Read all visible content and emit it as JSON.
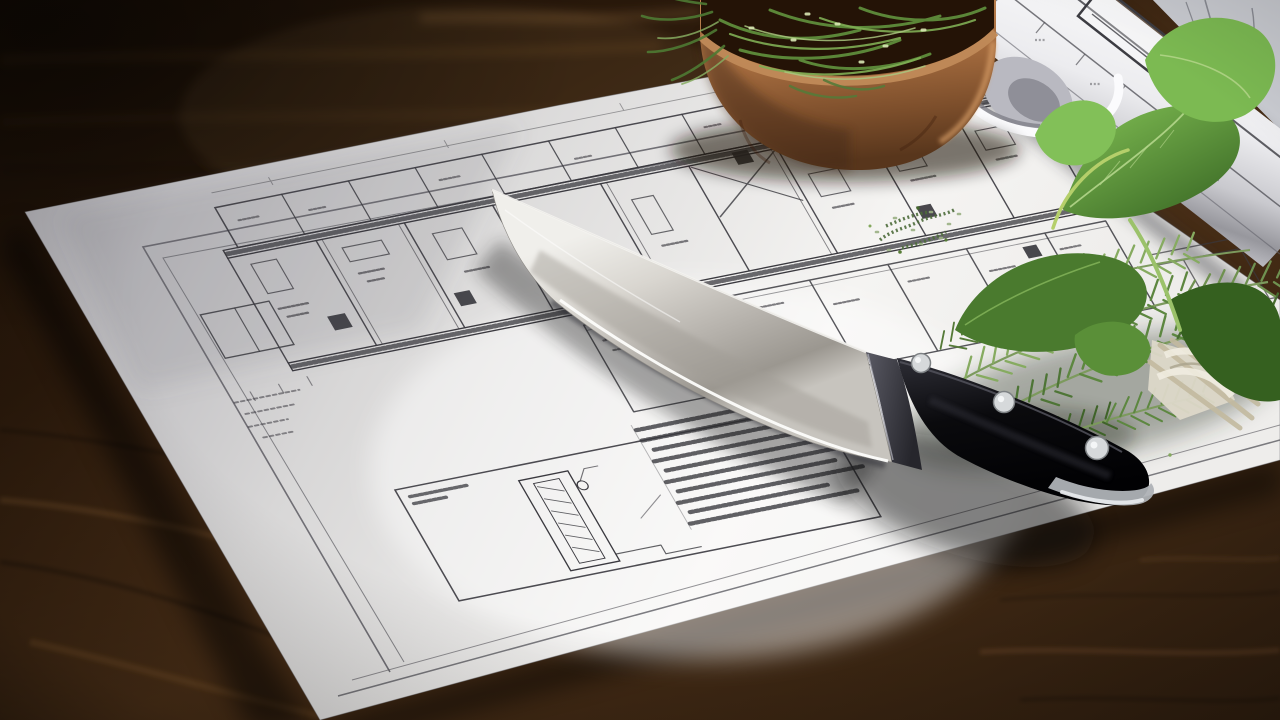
{
  "scene": {
    "title": "Chef's knife resting on architectural floor plans with fresh herbs on a dark wooden table",
    "setting": "dark rustic wooden table, warm side lighting, strong vignette",
    "objects": [
      {
        "name": "chef-knife",
        "parts": [
          "polished stainless blade",
          "dark steel bolster",
          "black handle",
          "three silver rivets",
          "steel butt cap"
        ]
      },
      {
        "name": "floor-plan-sheet",
        "details": [
          "double border frame",
          "two wings of small rooms",
          "hatched corridor walls",
          "black door symbols",
          "dimension scribbles",
          "detail panel with notes block"
        ]
      },
      {
        "name": "rolled-blueprint",
        "details": [
          "sketched schedule table",
          "long grid lines",
          "curled open end"
        ]
      },
      {
        "name": "background-sheet",
        "details": [
          "faint pencil lines"
        ]
      },
      {
        "name": "terracotta-bowl",
        "contents": "chopped green herbs spilling over the rim"
      },
      {
        "name": "herb-bouquet",
        "herbs": [
          "basil leaves",
          "rosemary sprigs",
          "thyme"
        ],
        "tie": "white twine around pale stems"
      },
      {
        "name": "herb-crumbs",
        "detail": "scattered chopped herb bits on the plan"
      }
    ]
  },
  "colors": {
    "wood_deep": "#1b1006",
    "wood_dark": "#2a190b",
    "wood_mid": "#4a2f17",
    "wood_warm": "#3a2512",
    "wood_edge": "#2c1c0e",
    "grain_light": "#8a5c2e",
    "paper_shadow": "#b0afb4",
    "paper_mid": "#d8d7d7",
    "paper_bright": "#f5f4f2",
    "paper_warm": "#eeedeb",
    "ink": "#3a393f",
    "blade_bright": "#f0efeb",
    "blade_light": "#d9d6d0",
    "blade_mid": "#b5b1ab",
    "blade_dark": "#9b9790",
    "blade_sheen": "#c7c4be",
    "edge_glint": "#fdfdfb",
    "bolster_light": "#5a5a64",
    "bolster_dark": "#26262c",
    "handle_high": "#2e2e36",
    "handle_dark": "#0a0a0d",
    "handle_black": "#010103",
    "rivet": "#d6d9db",
    "rivet_ring": "#7d8184",
    "butt_cap": "#aeb2b6",
    "bowl_light": "#c28753",
    "bowl_mid": "#a96f41",
    "bowl_dark": "#7c4e2b",
    "bowl_deep": "#58361c",
    "bowl_rim": "#c08a58",
    "bowl_interior": "#241306",
    "herb_light": "#8fb468",
    "herb_mid": "#587f3e",
    "herb_dark": "#33531f",
    "rosemary_stem": "#7c9a5d",
    "basil_light": "#83c155",
    "basil_dark": "#3c6b26",
    "basil_vein": "#b9d98f",
    "thyme": "#4d6b3a",
    "roll_bright": "#fafafb",
    "roll_light": "#ececef",
    "roll_mid": "#c9c9ce",
    "roll_dark": "#97979d",
    "roll_edge": "#b9b9bf",
    "backsheet": "#caccd2",
    "backsheet_line": "#7b7d85",
    "twine": "#ddd8c9",
    "stems_pale": "#c2b99f"
  }
}
